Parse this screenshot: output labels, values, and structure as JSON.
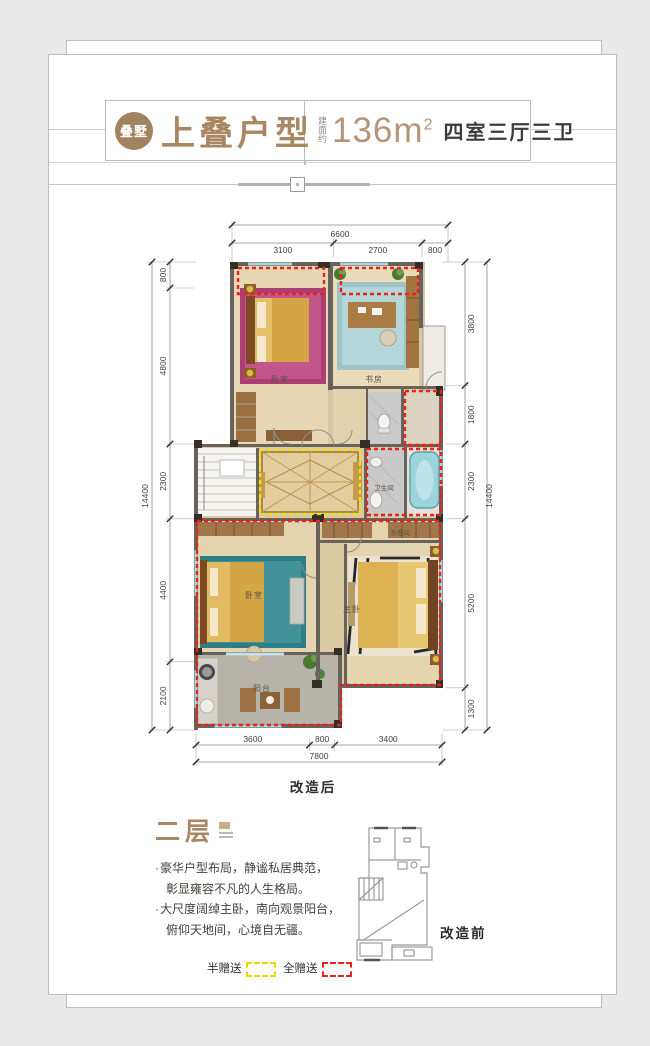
{
  "header": {
    "seal": "叠墅",
    "title": "上叠户型",
    "area_label": "建面约",
    "area_value": "136m",
    "area_sup": "2",
    "rooms_spec": "四室三厅三卫"
  },
  "plan": {
    "caption": "改造后",
    "rooms": {
      "bedroom_top": "卧室",
      "study": "书房",
      "bathroom": "卫生间",
      "cloakroom": "衣帽间",
      "bedroom_lower": "卧室",
      "master_bedroom": "主卧",
      "balcony": "阳台"
    },
    "dims": {
      "top_overall": "6600",
      "top_segments": [
        "3100",
        "2700",
        "800"
      ],
      "left_overall": "14400",
      "left_segments": [
        "800",
        "4800",
        "2300",
        "4400",
        "2100"
      ],
      "right_overall": "14400",
      "right_segments": [
        "3800",
        "1800",
        "2300",
        "5200",
        "1300"
      ],
      "bottom_overall": "7800",
      "bottom_segments": [
        "3600",
        "800",
        "3400"
      ]
    }
  },
  "description": {
    "floor_title": "二层",
    "bullet_char": "·",
    "bullets": [
      {
        "line1": "豪华户型布局，静谧私居典范，",
        "line2": "彰显雍容不凡的人生格局。"
      },
      {
        "line1": "大尺度阔绰主卧，南向观景阳台，",
        "line2": "俯仰天地间，心境自无疆。"
      }
    ],
    "small_plan_caption": "改造前"
  },
  "legend": {
    "half_gift_label": "半赠送",
    "half_gift_color": "#ecd800",
    "full_gift_label": "全赠送",
    "full_gift_color": "#e8231a"
  },
  "colors": {
    "accent_brown": "#a98762",
    "wall": "#67635c",
    "floor_tan": "#e4d4b0",
    "window_cyan": "#a9d6dc",
    "background": "#e9e9e9"
  }
}
